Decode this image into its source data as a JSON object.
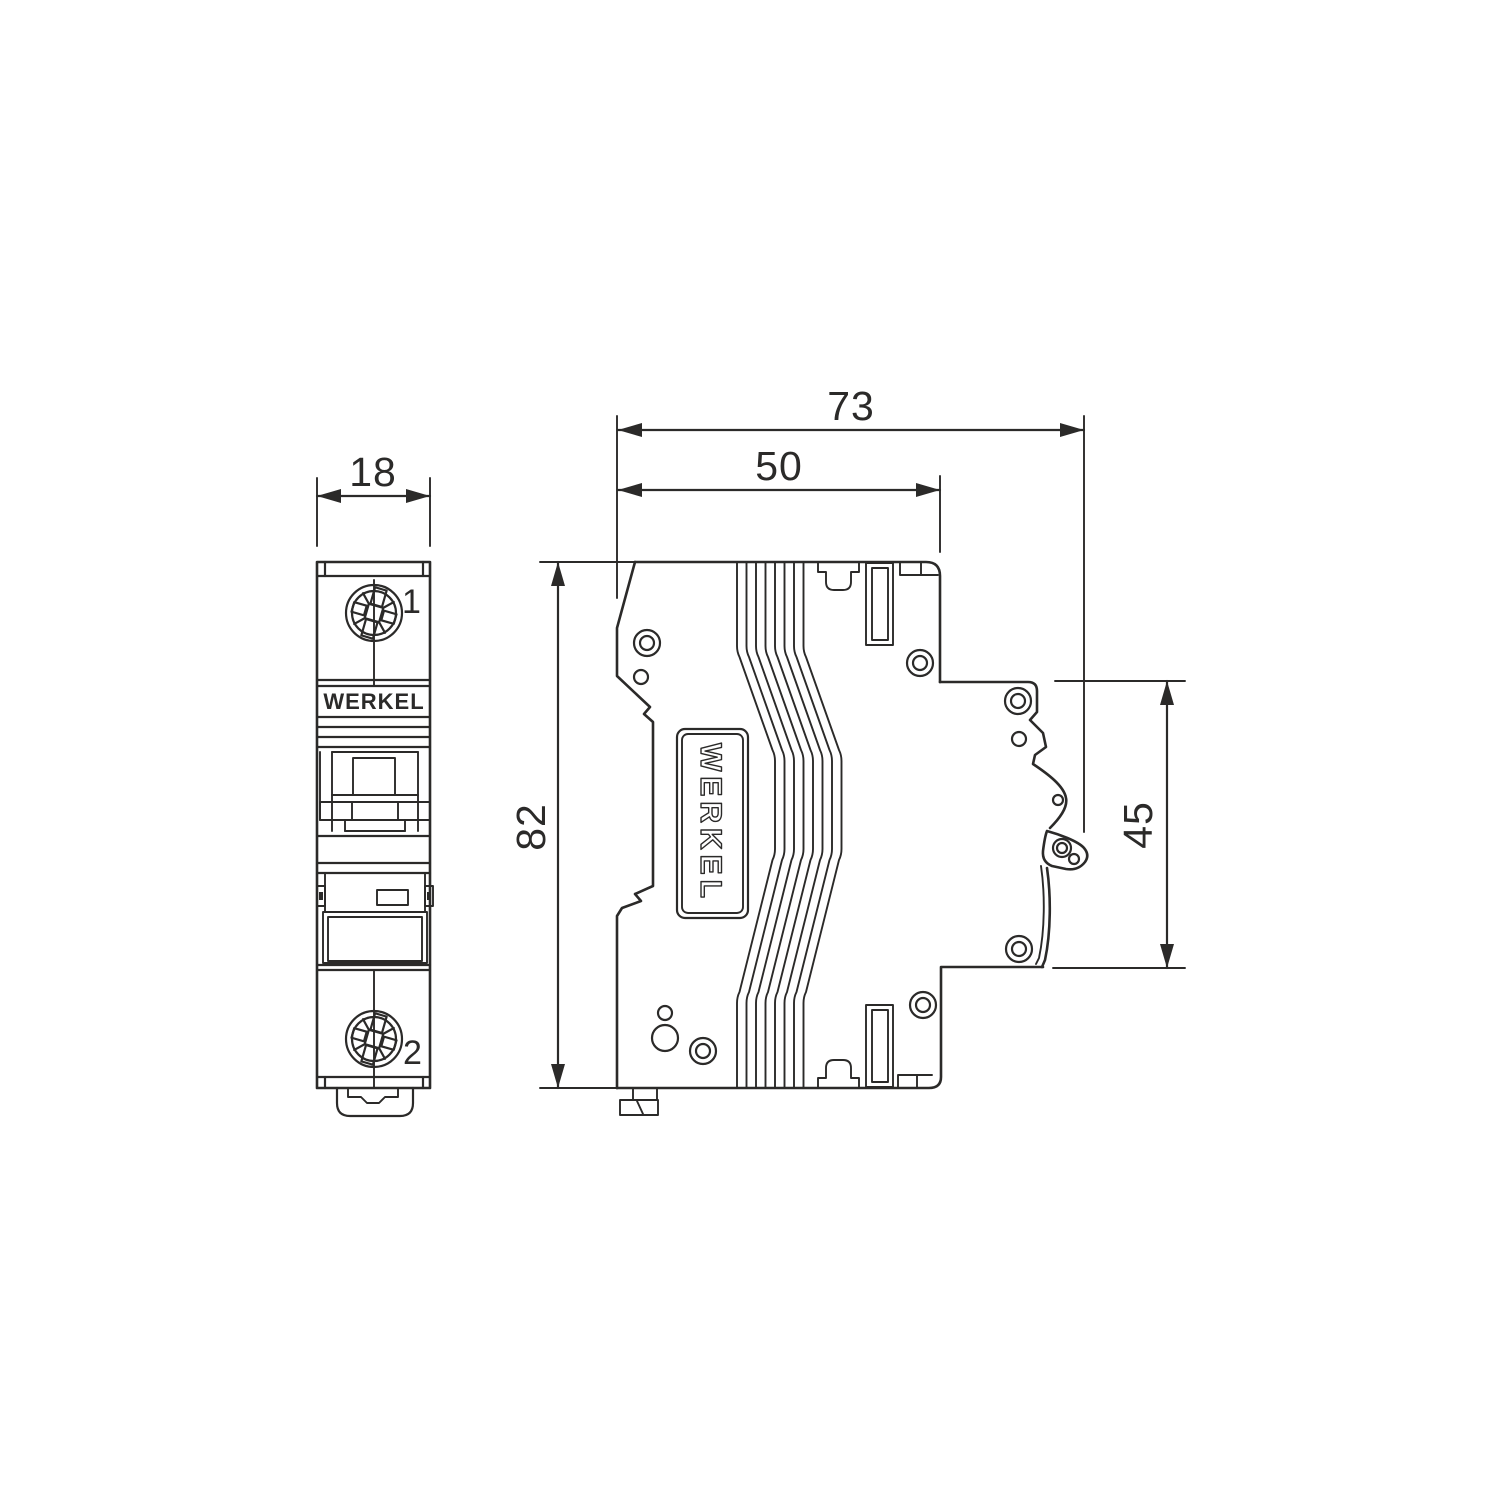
{
  "diagram": {
    "background": "#ffffff",
    "line_color": "#2b2a29",
    "brand": "WERKEL",
    "front_view": {
      "brand_label": "WERKEL",
      "terminal_top": "1",
      "terminal_bottom": "2"
    },
    "side_view": {
      "brand_label": "WERKEL"
    },
    "dimensions": {
      "front_width": "18",
      "total_depth": "73",
      "body_depth": "50",
      "height": "82",
      "rail_height": "45"
    }
  }
}
